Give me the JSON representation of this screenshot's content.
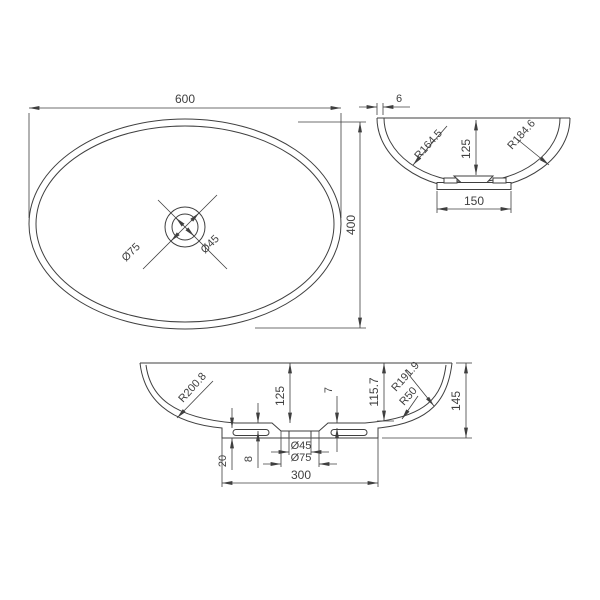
{
  "drawing": {
    "top_view": {
      "width": "600",
      "height": "400",
      "recess_dia": "Ø75",
      "drain_dia": "Ø45"
    },
    "side_view": {
      "rim_thickness": "6",
      "inner_radius": "R164.5",
      "depth": "125",
      "outer_radius": "R184.6",
      "base_width": "150"
    },
    "front_view": {
      "inner_radius": "R200.8",
      "depth": "125",
      "shell_thickness": "7",
      "inner_height": "115.7",
      "outer_radius": "R191.9",
      "corner_radius": "R50",
      "overall_height": "145",
      "base_height": "20",
      "recess_depth": "8",
      "drain_dia": "Ø45",
      "recess_dia": "Ø75",
      "base_width": "300"
    }
  },
  "colors": {
    "line": "#3f3f3f",
    "background": "#ffffff"
  }
}
